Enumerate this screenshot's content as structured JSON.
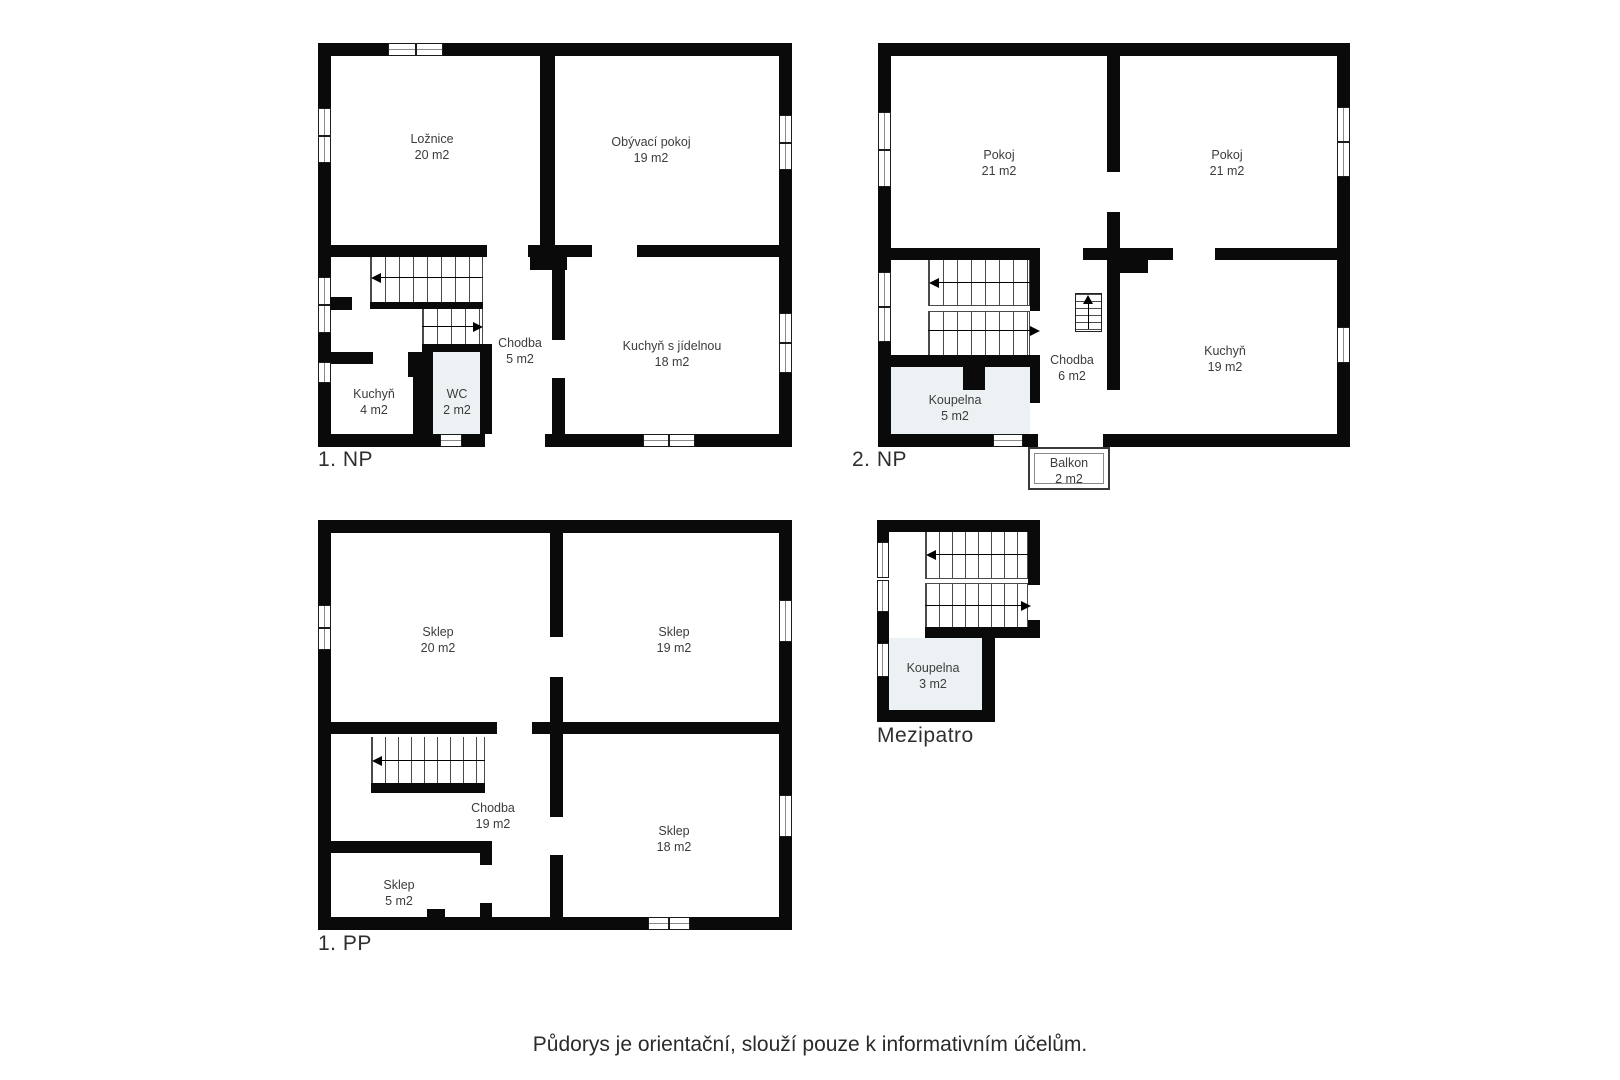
{
  "colors": {
    "wall": "#0a0a0a",
    "bath_tint": "#ecf2f4",
    "label_text": "#3c3c3c"
  },
  "floors": [
    {
      "label": "1. NP",
      "rooms": [
        {
          "name": "Ložnice",
          "area": "20 m2"
        },
        {
          "name": "Obývací pokoj",
          "area": "19 m2"
        },
        {
          "name": "Chodba",
          "area": "5 m2"
        },
        {
          "name": "Kuchyň s jídelnou",
          "area": "18 m2"
        },
        {
          "name": "Kuchyň",
          "area": "4 m2"
        },
        {
          "name": "WC",
          "area": "2 m2"
        }
      ]
    },
    {
      "label": "2. NP",
      "rooms": [
        {
          "name": "Pokoj",
          "area": "21 m2"
        },
        {
          "name": "Pokoj",
          "area": "21 m2"
        },
        {
          "name": "Chodba",
          "area": "6 m2"
        },
        {
          "name": "Kuchyň",
          "area": "19 m2"
        },
        {
          "name": "Koupelna",
          "area": "5 m2"
        },
        {
          "name": "Balkon",
          "area": "2 m2"
        }
      ]
    },
    {
      "label": "1. PP",
      "rooms": [
        {
          "name": "Sklep",
          "area": "20 m2"
        },
        {
          "name": "Sklep",
          "area": "19 m2"
        },
        {
          "name": "Chodba",
          "area": "19 m2"
        },
        {
          "name": "Sklep",
          "area": "18 m2"
        },
        {
          "name": "Sklep",
          "area": "5 m2"
        }
      ]
    },
    {
      "label": "Mezipatro",
      "rooms": [
        {
          "name": "Koupelna",
          "area": "3 m2"
        }
      ]
    }
  ],
  "footer": {
    "text": "Půdorys je orientační, slouží pouze k informativním účelům."
  }
}
